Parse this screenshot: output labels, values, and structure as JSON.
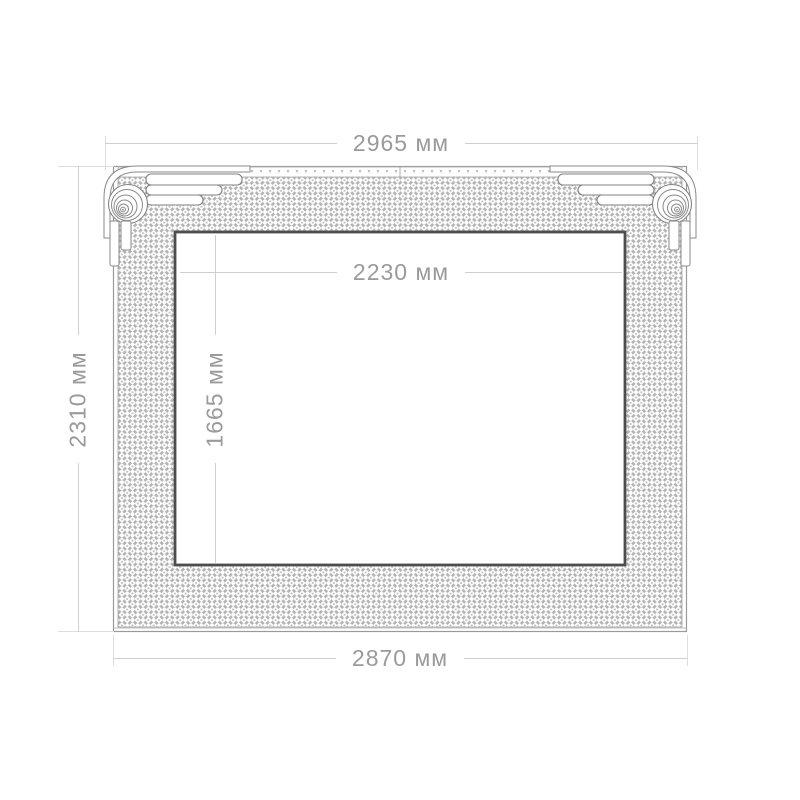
{
  "drawing": {
    "unit": "мм",
    "dimensions": {
      "outer_width": {
        "value": 2965,
        "unit": "мм",
        "label": "2965 мм"
      },
      "inner_width": {
        "value": 2230,
        "unit": "мм",
        "label": "2230 мм"
      },
      "outer_height": {
        "value": 2310,
        "unit": "мм",
        "label": "2310 мм"
      },
      "inner_height": {
        "value": 1665,
        "unit": "мм",
        "label": "1665 мм"
      },
      "bottom_width": {
        "value": 2870,
        "unit": "мм",
        "label": "2870 мм"
      }
    },
    "colors": {
      "dimension_text": "#9a9a9a",
      "dimension_line": "#cfcfcf",
      "extension_line": "#dedede",
      "frame_outline": "#8f8f8f",
      "inner_border": "#4d4d4d",
      "pattern_line": "#b2b2b2",
      "background": "#ffffff"
    }
  }
}
